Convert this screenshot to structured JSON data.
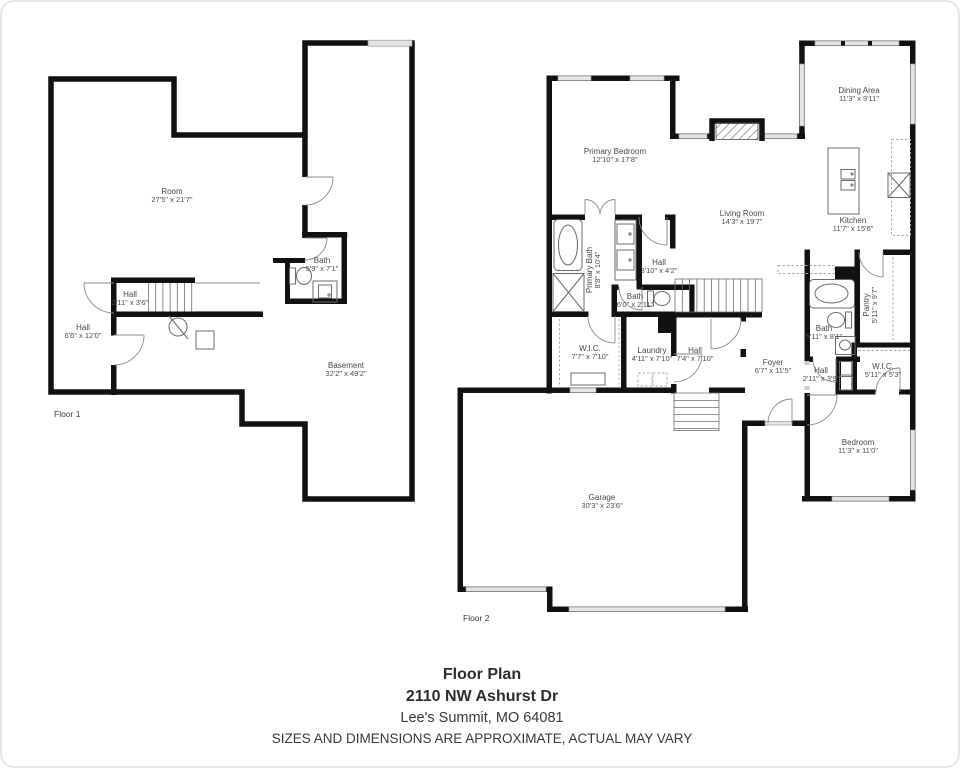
{
  "page": {
    "background": "#ffffff",
    "wall_color": "#111111",
    "window_color": "#e4e4e4"
  },
  "floor1": {
    "caption": "Floor 1",
    "rooms": {
      "room": {
        "name": "Room",
        "dims": "27'5\" x 21'7\""
      },
      "bath": {
        "name": "Bath",
        "dims": "5'9\" x 7'1\""
      },
      "hall_upper": {
        "name": "Hall",
        "dims": "2'11\" x 3'6\""
      },
      "hall_lower": {
        "name": "Hall",
        "dims": "6'6\" x 12'0\""
      },
      "basement": {
        "name": "Basement",
        "dims": "32'2\" x 49'2\""
      }
    }
  },
  "floor2": {
    "caption": "Floor 2",
    "rooms": {
      "primary_bedroom": {
        "name": "Primary Bedroom",
        "dims": "12'10\" x 17'8\""
      },
      "dining_area": {
        "name": "Dining Area",
        "dims": "11'3\" x 9'11\""
      },
      "living_room": {
        "name": "Living Room",
        "dims": "14'3\" x 19'7\""
      },
      "kitchen": {
        "name": "Kitchen",
        "dims": "11'7\" x 15'6\""
      },
      "primary_bath": {
        "name": "Primary Bath",
        "dims": "8'8\" x 10'4\""
      },
      "hall_upper": {
        "name": "Hall",
        "dims": "3'10\" x 4'2\""
      },
      "bath_half": {
        "name": "Bath",
        "dims": "6'0\" x 2'11\""
      },
      "wic_primary": {
        "name": "W.I.C.",
        "dims": "7'7\" x 7'10\""
      },
      "laundry": {
        "name": "Laundry",
        "dims": "4'11\" x 7'10\""
      },
      "hall_center": {
        "name": "Hall",
        "dims": "7'4\" x 7'10\""
      },
      "foyer": {
        "name": "Foyer",
        "dims": "6'7\" x 11'5\""
      },
      "pantry": {
        "name": "Pantry",
        "dims": "5'11\" x 9'7\""
      },
      "bath_full": {
        "name": "Bath",
        "dims": "5'11\" x 8'1\""
      },
      "hall_bedroom": {
        "name": "Hall",
        "dims": "2'11\" x 3'9\""
      },
      "wic_bedroom": {
        "name": "W.I.C.",
        "dims": "5'11\" x 5'3\""
      },
      "bedroom": {
        "name": "Bedroom",
        "dims": "11'3\" x 11'0\""
      },
      "garage": {
        "name": "Garage",
        "dims": "30'3\" x 23'6\""
      }
    }
  },
  "footer": {
    "title": "Floor Plan",
    "address": "2110 NW Ashurst Dr",
    "city_line": "Lee's Summit, MO  64081",
    "disclaimer": "SIZES AND DIMENSIONS ARE APPROXIMATE, ACTUAL MAY VARY"
  }
}
